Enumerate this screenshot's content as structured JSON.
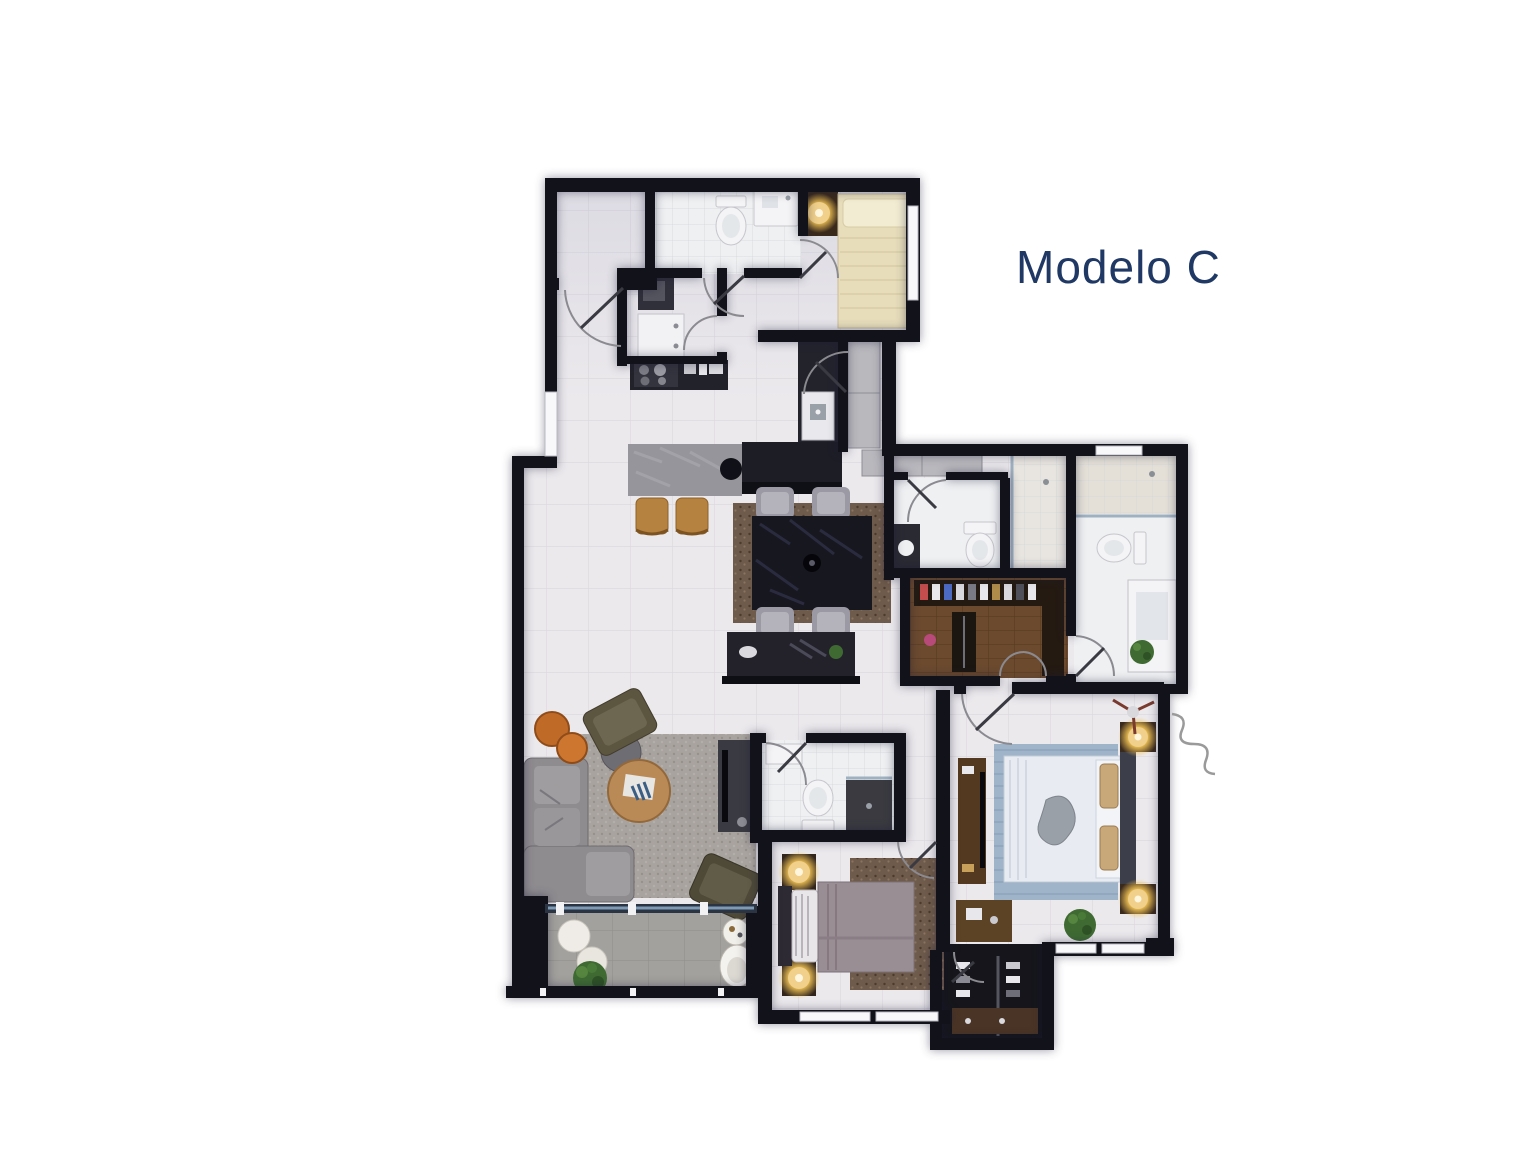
{
  "title": {
    "text": "Modelo C",
    "color": "#1f3864",
    "css": "color:#1f3864"
  },
  "canvas": {
    "background": "#ffffff"
  },
  "palette": {
    "wall": "#12121a",
    "floor": "#ebe9ec",
    "floor_line": "#dbd7dd",
    "bath_floor": "#eef0f2",
    "balcony_floor": "#a3a19d",
    "wood_floor": "#6b4a2e",
    "closet_dark": "#15151b",
    "counter_dark": "#22222b",
    "island_marble": "#96959b",
    "stool_wood": "#b5823f",
    "dining_rug": "#6e513c",
    "dining_table": "#171720",
    "chair_gray": "#9b9aa4",
    "living_rug": "#a8a39e",
    "sofa_gray": "#8f8c90",
    "armchair_olive": "#5c5540",
    "coffee_table_wood": "#b98a56",
    "side_table_orange": "#c06a28",
    "service_bed": "#e7ddbb",
    "bedroom2_bed": "#9a8e95",
    "bedroom2_rug": "#6f5b4b",
    "master_rug": "#9fb4c8",
    "master_bed": "#e8ecf2",
    "lamp_glow": "#f4c556",
    "plant_green": "#3f6b33",
    "fixture_white": "#f4f4f6",
    "door_arc": "#8a8a90"
  }
}
